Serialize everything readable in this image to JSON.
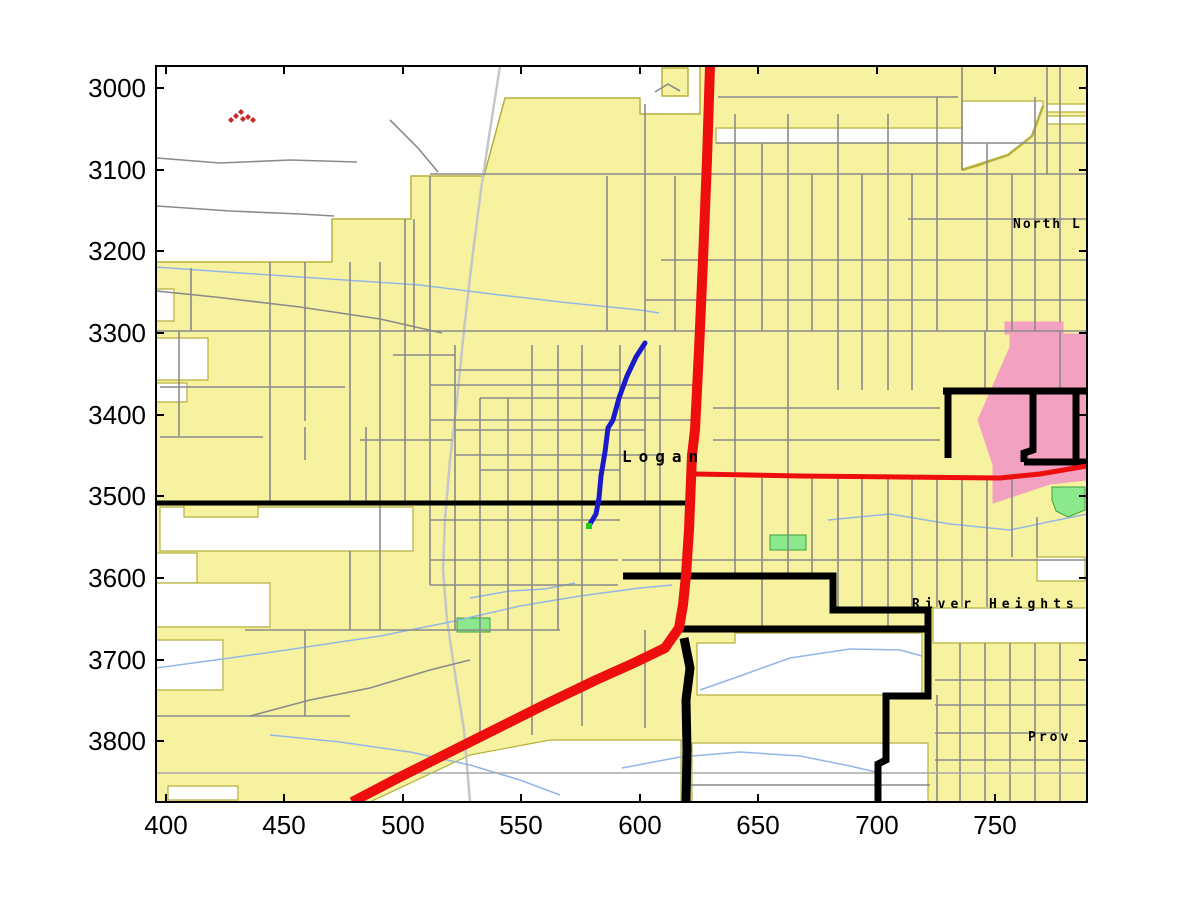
{
  "figure": {
    "width": 1200,
    "height": 901,
    "background": "#ffffff"
  },
  "axes": {
    "box": {
      "left": 156,
      "top": 66,
      "right": 1087,
      "bottom": 802
    },
    "tick_length": 8,
    "tick_font_size": 26,
    "x_ticks": [
      {
        "label": "400",
        "px": 166
      },
      {
        "label": "450",
        "px": 284
      },
      {
        "label": "500",
        "px": 403
      },
      {
        "label": "550",
        "px": 521
      },
      {
        "label": "600",
        "px": 640
      },
      {
        "label": "650",
        "px": 758
      },
      {
        "label": "700",
        "px": 877
      },
      {
        "label": "750",
        "px": 995
      }
    ],
    "y_ticks": [
      {
        "label": "3000",
        "py": 88
      },
      {
        "label": "3100",
        "py": 170
      },
      {
        "label": "3200",
        "py": 251
      },
      {
        "label": "3300",
        "py": 333
      },
      {
        "label": "3400",
        "py": 415
      },
      {
        "label": "3500",
        "py": 496
      },
      {
        "label": "3600",
        "py": 578
      },
      {
        "label": "3700",
        "py": 660
      },
      {
        "label": "3800",
        "py": 741
      }
    ]
  },
  "palette": {
    "urban": "#F7F2A0",
    "urban_border": "#B5B13A",
    "hole": "#FFFFFF",
    "water": "#93B6E6",
    "minor_road": "#8A8A8A",
    "long_road": "#A8A8A8",
    "railroad": "#C6C6C6",
    "major_road": "#000000",
    "highway": "#EE0E0E",
    "route_blue": "#1A1ACC",
    "route_end": "#22CC22",
    "park_green": "#8CE88C",
    "park_border": "#3AA33A",
    "district_pink": "#F2A2C0",
    "marker_red": "#C62828",
    "label": "#000000"
  },
  "map_labels": [
    {
      "text": "Logan",
      "x": 622,
      "y": 462,
      "size": 16,
      "spacing": 7,
      "weight": "bold"
    },
    {
      "text": "North L",
      "x": 1013,
      "y": 228,
      "size": 13,
      "spacing": 2,
      "weight": "bold"
    },
    {
      "text": "River Heights",
      "x": 912,
      "y": 608,
      "size": 13,
      "spacing": 5,
      "weight": "bold"
    },
    {
      "text": "Prov",
      "x": 1028,
      "y": 741,
      "size": 13,
      "spacing": 3,
      "weight": "bold"
    }
  ],
  "features": {
    "urban_polys": [
      [
        156,
        262,
        332,
        262,
        332,
        219,
        411,
        219,
        411,
        176,
        484,
        176,
        505,
        98,
        640,
        98,
        640,
        114,
        700,
        114,
        700,
        66,
        1087,
        66,
        1087,
        802,
        156,
        802
      ],
      [
        662,
        68,
        688,
        68,
        688,
        96,
        662,
        96
      ]
    ],
    "white_holes": [
      [
        156,
        289,
        174,
        289,
        174,
        321,
        156,
        321
      ],
      [
        156,
        338,
        208,
        338,
        208,
        380,
        156,
        380
      ],
      [
        156,
        383,
        187,
        383,
        187,
        402,
        156,
        402
      ],
      [
        160,
        507,
        413,
        507,
        413,
        551,
        160,
        551
      ],
      [
        156,
        553,
        197,
        553,
        197,
        583,
        156,
        583
      ],
      [
        156,
        583,
        270,
        583,
        270,
        627,
        156,
        627
      ],
      [
        156,
        640,
        223,
        640,
        223,
        690,
        156,
        690
      ],
      [
        168,
        786,
        238,
        786,
        238,
        800,
        168,
        800
      ],
      [
        370,
        802,
        470,
        755,
        550,
        740,
        681,
        740,
        681,
        802
      ],
      [
        692,
        743,
        928,
        743,
        928,
        802,
        692,
        802
      ],
      [
        697,
        643,
        735,
        643,
        735,
        633,
        922,
        633,
        922,
        695,
        697,
        695
      ],
      [
        933,
        608,
        1087,
        608,
        1087,
        643,
        933,
        643
      ],
      [
        1037,
        557,
        1085,
        557,
        1085,
        581,
        1037,
        581
      ],
      [
        716,
        128,
        962,
        128,
        962,
        143,
        716,
        143
      ],
      [
        962,
        101,
        1043,
        101,
        1043,
        106,
        1032,
        136,
        1008,
        155,
        978,
        166,
        962,
        170
      ],
      [
        1047,
        104,
        1087,
        104,
        1087,
        112,
        1047,
        112
      ],
      [
        1047,
        116,
        1087,
        116,
        1087,
        124,
        1047,
        124
      ]
    ],
    "urban_patches": [
      [
        184,
        505,
        258,
        505,
        258,
        517,
        184,
        517
      ]
    ],
    "pink_polys": [
      [
        1005,
        322,
        1063,
        322,
        1063,
        334,
        1005,
        334
      ],
      [
        1010,
        334,
        1087,
        334,
        1087,
        480,
        1050,
        484,
        993,
        503,
        993,
        465,
        978,
        420,
        1010,
        347
      ]
    ],
    "green_patches": [
      [
        457,
        618,
        490,
        618,
        490,
        632,
        457,
        632
      ],
      [
        770,
        535,
        806,
        535,
        806,
        550,
        770,
        550
      ],
      [
        1052,
        487,
        1085,
        487,
        1085,
        510,
        1068,
        517,
        1056,
        511,
        1052,
        500
      ]
    ],
    "olive_curves": [
      [
        1043,
        106,
        1032,
        136,
        1008,
        155,
        962,
        170
      ]
    ],
    "railroad": {
      "w": 2.5,
      "pts": [
        500,
        66,
        490,
        130,
        481,
        190,
        472,
        260,
        464,
        330,
        457,
        400,
        450,
        460,
        445,
        520,
        443,
        570,
        447,
        620,
        456,
        680,
        464,
        730,
        470,
        802
      ]
    },
    "streams": [
      [
        156,
        267,
        240,
        273,
        330,
        279,
        420,
        285,
        500,
        295,
        570,
        303,
        640,
        310,
        659,
        313
      ],
      [
        156,
        668,
        230,
        658,
        300,
        648,
        380,
        636,
        450,
        622,
        520,
        606,
        580,
        596,
        640,
        588,
        672,
        585
      ],
      [
        700,
        690,
        740,
        676,
        790,
        658,
        850,
        649,
        900,
        650,
        922,
        656
      ],
      [
        622,
        768,
        680,
        757,
        740,
        752,
        800,
        756,
        850,
        766,
        876,
        772
      ],
      [
        270,
        735,
        340,
        742,
        410,
        752,
        470,
        765,
        520,
        780,
        560,
        795
      ],
      [
        828,
        520,
        890,
        514,
        950,
        524,
        1010,
        530,
        1053,
        521,
        1087,
        514
      ],
      [
        470,
        598,
        510,
        591,
        545,
        589,
        575,
        583
      ]
    ],
    "minor_roads": [
      [
        157,
        158,
        220,
        163,
        290,
        160,
        357,
        162
      ],
      [
        157,
        206,
        230,
        211,
        300,
        214,
        334,
        216
      ],
      [
        390,
        120,
        418,
        148,
        438,
        172
      ],
      [
        156,
        291,
        215,
        297,
        300,
        307,
        380,
        319,
        442,
        333
      ],
      [
        655,
        92,
        668,
        84,
        680,
        91
      ],
      [
        191,
        268,
        191,
        331
      ],
      [
        179,
        331,
        179,
        436
      ],
      [
        160,
        387,
        345,
        387
      ],
      [
        160,
        437,
        263,
        437
      ],
      [
        360,
        440,
        452,
        440
      ],
      [
        305,
        427,
        305,
        460
      ],
      [
        366,
        427,
        366,
        503
      ],
      [
        414,
        219,
        414,
        331
      ],
      [
        393,
        355,
        455,
        355
      ],
      [
        156,
        331,
        1087,
        331
      ],
      [
        430,
        174,
        1087,
        174
      ],
      [
        645,
        300,
        1087,
        300
      ],
      [
        661,
        260,
        1087,
        260
      ],
      [
        908,
        219,
        1087,
        219
      ],
      [
        716,
        143,
        1087,
        143
      ],
      [
        718,
        97,
        958,
        97
      ],
      [
        430,
        385,
        697,
        385
      ],
      [
        430,
        420,
        697,
        420
      ],
      [
        455,
        455,
        660,
        455
      ],
      [
        430,
        520,
        620,
        520
      ],
      [
        430,
        560,
        618,
        560
      ],
      [
        622,
        560,
        1087,
        560
      ],
      [
        430,
        585,
        618,
        585
      ],
      [
        245,
        630,
        560,
        630
      ],
      [
        156,
        716,
        350,
        716
      ],
      [
        935,
        680,
        1087,
        680
      ],
      [
        935,
        705,
        1087,
        705
      ],
      [
        935,
        733,
        1060,
        733
      ],
      [
        935,
        760,
        1087,
        760
      ],
      [
        690,
        785,
        930,
        785
      ],
      [
        713,
        408,
        940,
        408
      ],
      [
        713,
        440,
        940,
        440
      ],
      [
        455,
        370,
        620,
        370
      ],
      [
        480,
        398,
        660,
        398
      ],
      [
        455,
        430,
        645,
        430
      ],
      [
        480,
        470,
        620,
        470
      ],
      [
        645,
        104,
        645,
        331
      ],
      [
        675,
        176,
        675,
        331
      ],
      [
        735,
        114,
        735,
        331
      ],
      [
        762,
        143,
        762,
        331
      ],
      [
        788,
        114,
        788,
        331
      ],
      [
        812,
        174,
        812,
        331
      ],
      [
        838,
        114,
        838,
        331
      ],
      [
        862,
        174,
        862,
        331
      ],
      [
        888,
        114,
        888,
        331
      ],
      [
        912,
        174,
        912,
        331
      ],
      [
        937,
        97,
        937,
        331
      ],
      [
        962,
        66,
        962,
        170
      ],
      [
        987,
        143,
        987,
        331
      ],
      [
        1012,
        174,
        1012,
        331
      ],
      [
        1035,
        97,
        1035,
        331
      ],
      [
        1047,
        66,
        1047,
        175
      ],
      [
        1060,
        66,
        1060,
        322
      ],
      [
        735,
        331,
        735,
        475
      ],
      [
        788,
        331,
        788,
        475
      ],
      [
        838,
        331,
        838,
        390
      ],
      [
        862,
        331,
        862,
        390
      ],
      [
        888,
        331,
        888,
        390
      ],
      [
        912,
        331,
        912,
        390
      ],
      [
        985,
        331,
        985,
        390
      ],
      [
        1060,
        331,
        1060,
        390
      ],
      [
        735,
        478,
        735,
        576
      ],
      [
        762,
        478,
        762,
        629
      ],
      [
        788,
        478,
        788,
        576
      ],
      [
        812,
        478,
        812,
        576
      ],
      [
        838,
        478,
        838,
        610
      ],
      [
        862,
        478,
        862,
        610
      ],
      [
        888,
        478,
        888,
        629
      ],
      [
        912,
        478,
        912,
        610
      ],
      [
        937,
        478,
        937,
        607
      ],
      [
        962,
        478,
        962,
        607
      ],
      [
        987,
        478,
        987,
        607
      ],
      [
        1012,
        478,
        1012,
        557
      ],
      [
        1037,
        517,
        1037,
        557
      ],
      [
        937,
        695,
        937,
        802
      ],
      [
        960,
        643,
        960,
        802
      ],
      [
        985,
        643,
        985,
        802
      ],
      [
        1010,
        643,
        1010,
        802
      ],
      [
        1035,
        643,
        1035,
        802
      ],
      [
        1060,
        643,
        1060,
        802
      ],
      [
        430,
        176,
        430,
        585
      ],
      [
        455,
        345,
        455,
        630
      ],
      [
        480,
        398,
        480,
        740
      ],
      [
        508,
        398,
        508,
        630
      ],
      [
        532,
        345,
        532,
        735
      ],
      [
        558,
        345,
        558,
        630
      ],
      [
        582,
        345,
        582,
        630
      ],
      [
        607,
        176,
        607,
        331
      ],
      [
        620,
        345,
        620,
        503
      ],
      [
        645,
        345,
        645,
        503
      ],
      [
        660,
        345,
        660,
        576
      ],
      [
        645,
        630,
        645,
        728
      ],
      [
        582,
        630,
        582,
        726
      ],
      [
        350,
        262,
        350,
        503
      ],
      [
        380,
        262,
        380,
        630
      ],
      [
        405,
        219,
        405,
        503
      ],
      [
        270,
        262,
        270,
        503
      ],
      [
        305,
        262,
        305,
        421
      ],
      [
        350,
        551,
        350,
        630
      ],
      [
        305,
        630,
        305,
        716
      ],
      [
        250,
        716,
        310,
        700,
        370,
        688,
        430,
        670,
        470,
        660
      ]
    ],
    "long_light_road": {
      "w": 1.4,
      "pts": [
        156,
        773,
        1087,
        773
      ]
    },
    "major_black_roads": [
      {
        "w": 5,
        "pts": [
          156,
          503,
          691,
          503
        ]
      },
      {
        "w": 7,
        "pts": [
          623,
          576,
          833,
          576,
          833,
          610,
          928,
          610,
          928,
          696,
          886,
          696,
          886,
          760,
          878,
          764,
          878,
          802
        ]
      },
      {
        "w": 7,
        "pts": [
          678,
          629,
          928,
          629
        ]
      },
      {
        "w": 9,
        "pts": [
          684,
          638,
          690,
          668,
          686,
          700,
          687,
          750,
          686,
          802
        ]
      },
      {
        "w": 7,
        "pts": [
          943,
          391,
          1087,
          391
        ]
      },
      {
        "w": 7,
        "pts": [
          948,
          391,
          948,
          458
        ]
      },
      {
        "w": 7,
        "pts": [
          1033,
          391,
          1033,
          450,
          1024,
          453,
          1024,
          462
        ]
      },
      {
        "w": 7,
        "pts": [
          1024,
          462,
          1087,
          462
        ]
      },
      {
        "w": 7,
        "pts": [
          1076,
          391,
          1076,
          462
        ]
      }
    ],
    "highways_red": [
      {
        "w": 10,
        "pts": [
          710,
          66,
          707,
          160,
          703,
          260,
          699,
          350,
          695,
          430,
          692,
          455,
          689,
          530,
          686,
          575,
          683,
          605,
          679,
          628,
          665,
          648,
          636,
          662,
          596,
          680,
          548,
          703,
          470,
          742,
          398,
          778,
          352,
          802
        ]
      },
      {
        "w": 5,
        "pts": [
          695,
          474,
          800,
          476,
          900,
          477,
          1000,
          478,
          1040,
          474,
          1075,
          468,
          1087,
          466
        ]
      }
    ],
    "blue_route": {
      "w": 5,
      "pts": [
        645,
        343,
        636,
        357,
        627,
        376,
        619,
        398,
        613,
        420,
        608,
        428,
        605,
        452,
        601,
        476,
        599,
        498,
        596,
        514,
        590,
        524
      ],
      "end_dot": [
        589,
        526
      ]
    },
    "red_markers": [
      [
        231,
        120
      ],
      [
        236,
        116
      ],
      [
        241,
        112
      ],
      [
        243,
        119
      ],
      [
        248,
        117
      ],
      [
        253,
        120
      ]
    ]
  }
}
